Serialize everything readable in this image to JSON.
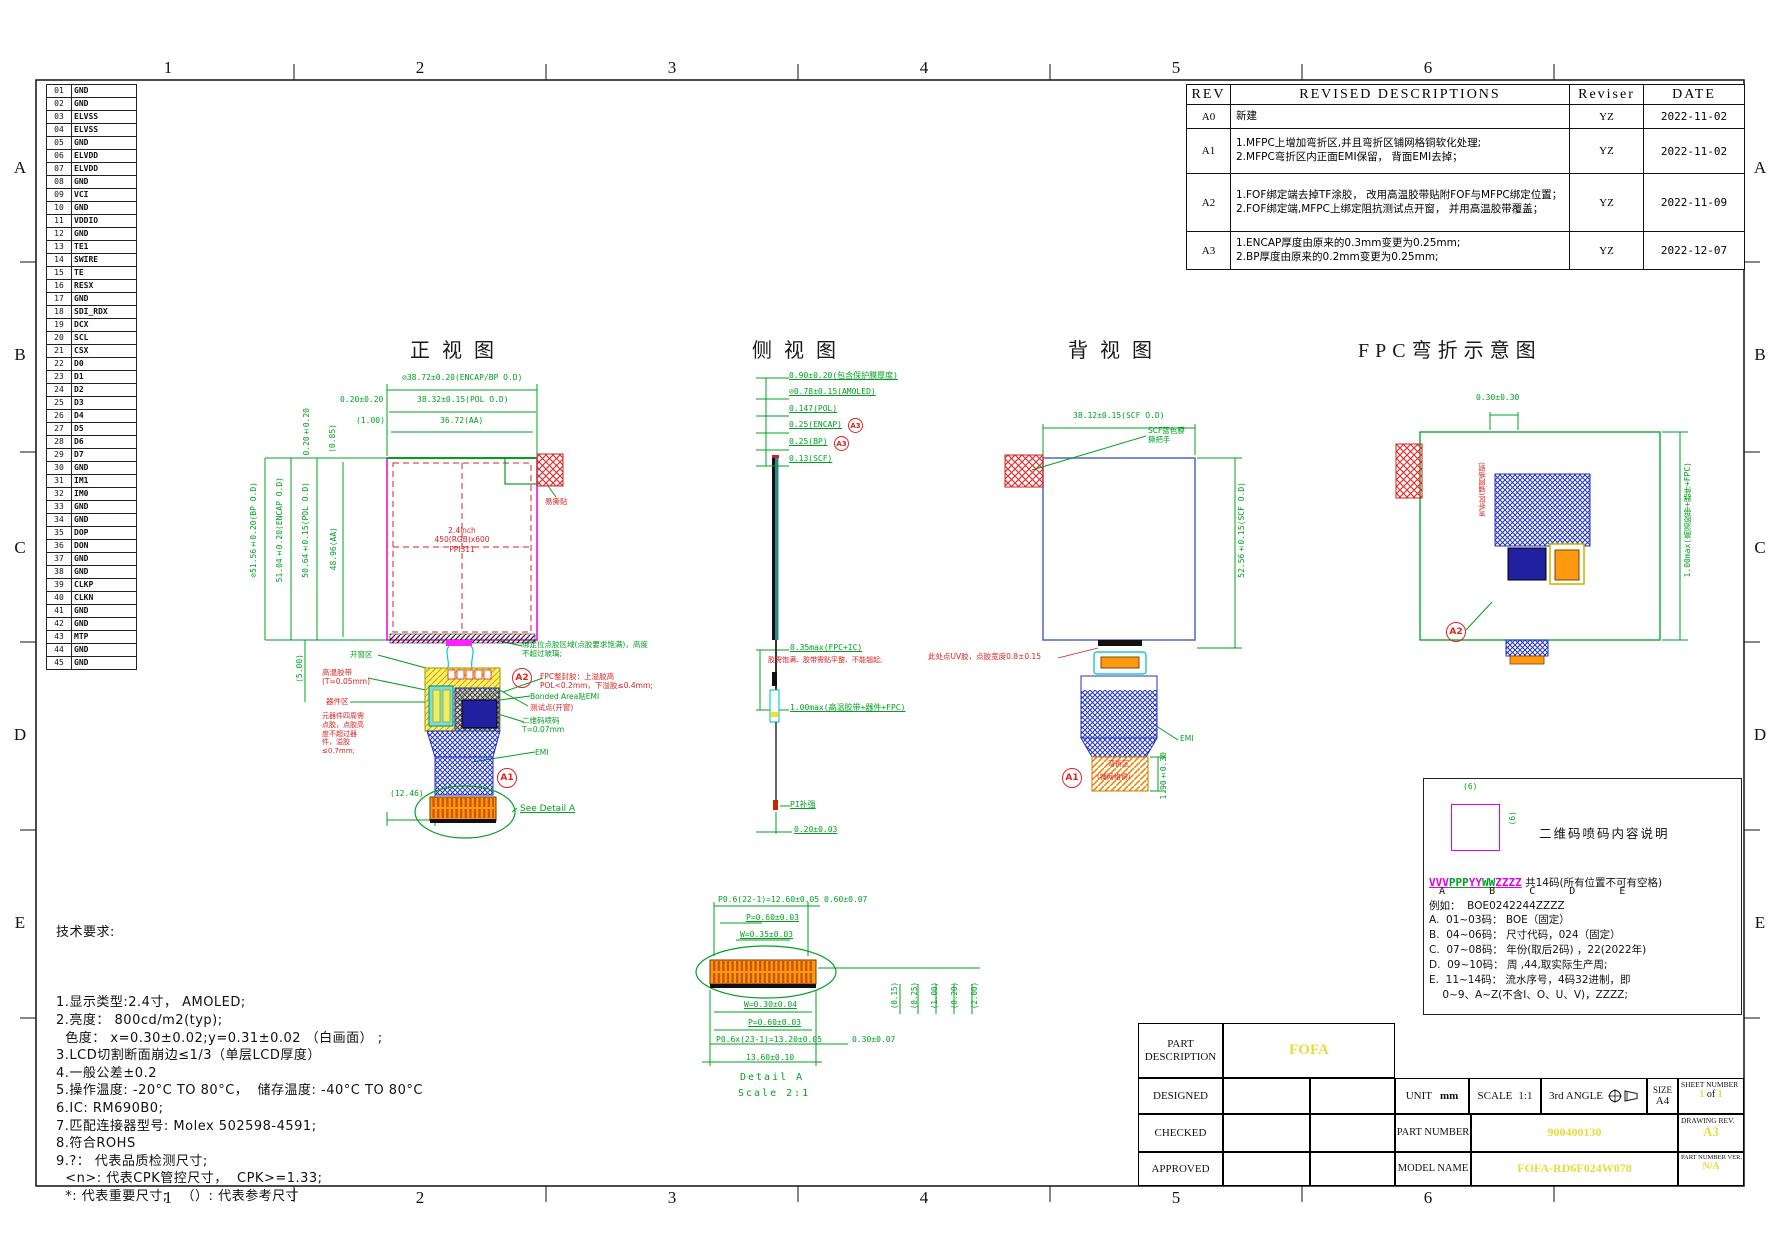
{
  "page": {
    "zone_numbers": [
      "1",
      "2",
      "3",
      "4",
      "5",
      "6"
    ],
    "zone_letters": [
      "A",
      "B",
      "C",
      "D",
      "E"
    ]
  },
  "pin_table": {
    "rows": [
      {
        "no": "01",
        "name": "GND"
      },
      {
        "no": "02",
        "name": "GND"
      },
      {
        "no": "03",
        "name": "ELVSS"
      },
      {
        "no": "04",
        "name": "ELVSS"
      },
      {
        "no": "05",
        "name": "GND"
      },
      {
        "no": "06",
        "name": "ELVDD"
      },
      {
        "no": "07",
        "name": "ELVDD"
      },
      {
        "no": "08",
        "name": "GND"
      },
      {
        "no": "09",
        "name": "VCI"
      },
      {
        "no": "10",
        "name": "GND"
      },
      {
        "no": "11",
        "name": "VDDIO"
      },
      {
        "no": "12",
        "name": "GND"
      },
      {
        "no": "13",
        "name": "TE1"
      },
      {
        "no": "14",
        "name": "SWIRE"
      },
      {
        "no": "15",
        "name": "TE"
      },
      {
        "no": "16",
        "name": "RESX"
      },
      {
        "no": "17",
        "name": "GND"
      },
      {
        "no": "18",
        "name": "SDI_RDX"
      },
      {
        "no": "19",
        "name": "DCX"
      },
      {
        "no": "20",
        "name": "SCL"
      },
      {
        "no": "21",
        "name": "CSX"
      },
      {
        "no": "22",
        "name": "D0"
      },
      {
        "no": "23",
        "name": "D1"
      },
      {
        "no": "24",
        "name": "D2"
      },
      {
        "no": "25",
        "name": "D3"
      },
      {
        "no": "26",
        "name": "D4"
      },
      {
        "no": "27",
        "name": "D5"
      },
      {
        "no": "28",
        "name": "D6"
      },
      {
        "no": "29",
        "name": "D7"
      },
      {
        "no": "30",
        "name": "GND"
      },
      {
        "no": "31",
        "name": "IM1"
      },
      {
        "no": "32",
        "name": "IM0"
      },
      {
        "no": "33",
        "name": "GND"
      },
      {
        "no": "34",
        "name": "GND"
      },
      {
        "no": "35",
        "name": "DOP"
      },
      {
        "no": "36",
        "name": "DON"
      },
      {
        "no": "37",
        "name": "GND"
      },
      {
        "no": "38",
        "name": "GND"
      },
      {
        "no": "39",
        "name": "CLKP"
      },
      {
        "no": "40",
        "name": "CLKN"
      },
      {
        "no": "41",
        "name": "GND"
      },
      {
        "no": "42",
        "name": "GND"
      },
      {
        "no": "43",
        "name": "MTP"
      },
      {
        "no": "44",
        "name": "GND"
      },
      {
        "no": "45",
        "name": "GND"
      }
    ]
  },
  "revisions": {
    "headers": {
      "rev": "REV",
      "desc": "REVISED DESCRIPTIONS",
      "reviser": "Reviser",
      "date": "DATE"
    },
    "rows": [
      {
        "rev": "A0",
        "desc": "新建",
        "reviser": "YZ",
        "date": "2022-11-02"
      },
      {
        "rev": "A1",
        "desc": "1.MFPC上增加弯折区,并且弯折区铺网格铜软化处理;\n2.MFPC弯折区内正面EMI保留， 背面EMI去掉；",
        "reviser": "YZ",
        "date": "2022-11-02"
      },
      {
        "rev": "A2",
        "desc": "1.FOF绑定端去掉TF涂胶， 改用高温胶带贴附FOF与MFPC绑定位置；\n2.FOF绑定端,MFPC上绑定阻抗测试点开窗， 并用高温胶带覆盖；",
        "reviser": "YZ",
        "date": "2022-11-09"
      },
      {
        "rev": "A3",
        "desc": "1.ENCAP厚度由原来的0.3mm变更为0.25mm;\n2.BP厚度由原来的0.2mm变更为0.25mm;",
        "reviser": "YZ",
        "date": "2022-12-07"
      }
    ]
  },
  "views": {
    "front": {
      "title": "正视图",
      "dim_encap_bp": "⊘38.72±0.20(ENCAP/BP O.D)",
      "dim_020": "0.20±0.20",
      "dim_pol": "38.32±0.15(POL O.D)",
      "dim_100": "(1.00)",
      "dim_aa": "36.72(AA)",
      "dim_bp_v": "⊘51.56±0.20(BP O.D)",
      "dim_encap_v": "51.04±0.20(ENCAP O.D)",
      "dim_pol_v": "50.64±0.15(POL O.D)",
      "dim_aa_v": "48.96(AA)",
      "dim_020_v": "0.20±0.20",
      "dim_085": "(0.85)",
      "dim_500": "(5.00)",
      "dim_1246": "(12.46)",
      "panel_line1": "2.4inch",
      "panel_line2": "450(RGB)x600",
      "panel_line3": "PPI311",
      "ann_tear": "易撕贴",
      "ann_window": "开窗区",
      "ann_tape": "高温胶带 (T≈0.05mm)",
      "ann_comp": "器件区",
      "ann_glue": "元器件四周需点胶，点胶高度不超过器件，溢胶≤0.7mm;",
      "ann_bond": "绑定位点胶区域(点胶要求饱满)，高度不超过玻璃;",
      "ann_seal": "FPC整封胶：上溢胶高POL<0.2mm，下溢胶≤0.4mm;",
      "ann_emi_area": "Bonded Area贴EMI",
      "ann_test": "测试点(开窗)",
      "ann_qr": "二维码喷码 T=0.07mm",
      "ann_emi": "EMI",
      "see_detail": "See Detail A",
      "a1": "A1",
      "a2": "A2"
    },
    "side": {
      "title": "侧视图",
      "dims": [
        "0.90±0.20(包含保护膜厚度)",
        "⊘0.78±0.15(AMOLED)",
        "0.147(POL)",
        "0.25(ENCAP)",
        "0.25(BP)",
        "0.13(SCF)"
      ],
      "a3": "A3",
      "dim_fpc": "0.35max(FPC+IC)",
      "ann_glue": "胶需饱满、胶带需贴平整、不能翘起;",
      "dim_stack": "1.00max(高温胶带+器件+FPC)",
      "ann_pi": "PI补强",
      "dim_pi": "0.20±0.03"
    },
    "back": {
      "title": "背视图",
      "dim_scf_h": "38.12±0.15(SCF O.D)",
      "dim_scf_v": "52.56±0.15(SCF O.D)",
      "ann_film1": "SCF蓝色膜",
      "ann_film2": "撕把手",
      "ann_uv": "此处点UV胶，点胶宽度0.8±0.15",
      "ann_emi": "EMI",
      "bend1": "弯折区",
      "bend2": "(铺网格铜)",
      "dim_bend": "1.90±0.30",
      "a1": "A1"
    },
    "fpc": {
      "title": "FPC弯折示意图",
      "dim_top": "0.30±0.30",
      "bend_label": "弯折区(铺网格铜)",
      "dim_right": "1.00max(高温胶带+器件+FPC)",
      "a2": "A2"
    }
  },
  "detail_a": {
    "dim_p22": "P0.6(22-1)=12.60±0.05",
    "dim_060": "0.60±0.07",
    "dim_p_top": "P=0.60±0.03",
    "dim_w_top": "W=0.35±0.03",
    "dim_w_bot": "W=0.30±0.04",
    "dim_p_bot": "P=0.60±0.03",
    "dim_p23": "P0.6x(23-1)=13.20±0.05",
    "dim_030": "0.30±0.07",
    "dim_1360": "13.60±0.10",
    "caption1": "Detail A",
    "caption2": "Scale 2:1",
    "refs": [
      "(0.15)",
      "(0.25)",
      "(1.00)",
      "(0.20)",
      "(2.00)"
    ]
  },
  "tech": {
    "title": "技术要求:",
    "lines": [
      "1.显示类型:2.4寸， AMOLED;",
      "2.亮度： 800cd/m2(typ);",
      "  色度： x=0.30±0.02;y=0.31±0.02 （白画面） ;",
      "3.LCD切割断面崩边≤1/3（单层LCD厚度）",
      "4.一般公差±0.2",
      "5.操作温度: -20°C TO 80°C，  储存温度: -40°C TO 80°C",
      "6.IC: RM690B0;",
      "7.匹配连接器型号: Molex 502598-4591;",
      "8.符合ROHS",
      "9.?： 代表品质检测尺寸;",
      "  <n>: 代表CPK管控尺寸，  CPK>=1.33;",
      "  *: 代表重要尺寸;   （）: 代表参考尺寸"
    ]
  },
  "qr": {
    "title": "二维码喷码内容说明",
    "dim_w": "(6)",
    "dim_h": "(6)",
    "seg_v": "VVV",
    "seg_p": "PPP",
    "seg_y": "YY",
    "seg_w": "WW",
    "seg_z": "ZZZZ",
    "suffix": " 共14码(所有位置不可有空格)",
    "letters": " A    B   C   D    E",
    "example": "例如：  BOE0242244ZZZZ",
    "items": [
      "A.  01~03码： BOE（固定）",
      "B.  04~06码： 尺寸代码，024（固定）",
      "C.  07~08码： 年份(取后2码) ，22(2022年)",
      "D.  09~10码： 周 ,44,取实际生产周;",
      "E.  11~14码： 流水序号，4码32进制，即",
      "    0~9、A~Z(不含I、O、U、V)，ZZZZ;"
    ]
  },
  "title_block": {
    "part_description_label": "PART\nDESCRIPTION",
    "part_description": "FOFA",
    "designed": "DESIGNED",
    "checked": "CHECKED",
    "approved": "APPROVED",
    "unit_label": "UNIT",
    "unit": "mm",
    "scale_label": "SCALE",
    "scale": "1:1",
    "angle": "3rd ANGLE",
    "size_label": "SIZE",
    "size": "A4",
    "sheet_label": "SHEET NUMBER",
    "sheet_current": "1",
    "sheet_of": "of",
    "sheet_total": "1",
    "part_number_label": "PART NUMBER",
    "part_number": "900400130",
    "drawing_rev_label": "DRAWING REV.",
    "drawing_rev": "A3",
    "model_name_label": "MODEL NAME",
    "model_name": "FOFA-RD6F024W078",
    "pn_ver_label": "PART NUMBER VER.",
    "pn_ver": "N/A"
  }
}
